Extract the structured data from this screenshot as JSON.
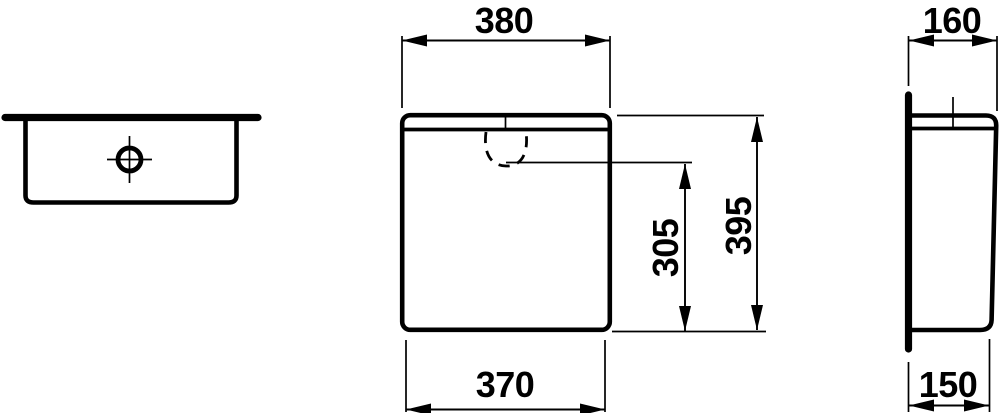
{
  "colors": {
    "line": "#000000",
    "background": "#ffffff"
  },
  "dimensions": {
    "front_width_top": "380",
    "front_width_bottom": "370",
    "front_recess_height": "305",
    "front_total_height": "395",
    "side_depth_top": "160",
    "side_depth_bottom": "150"
  }
}
